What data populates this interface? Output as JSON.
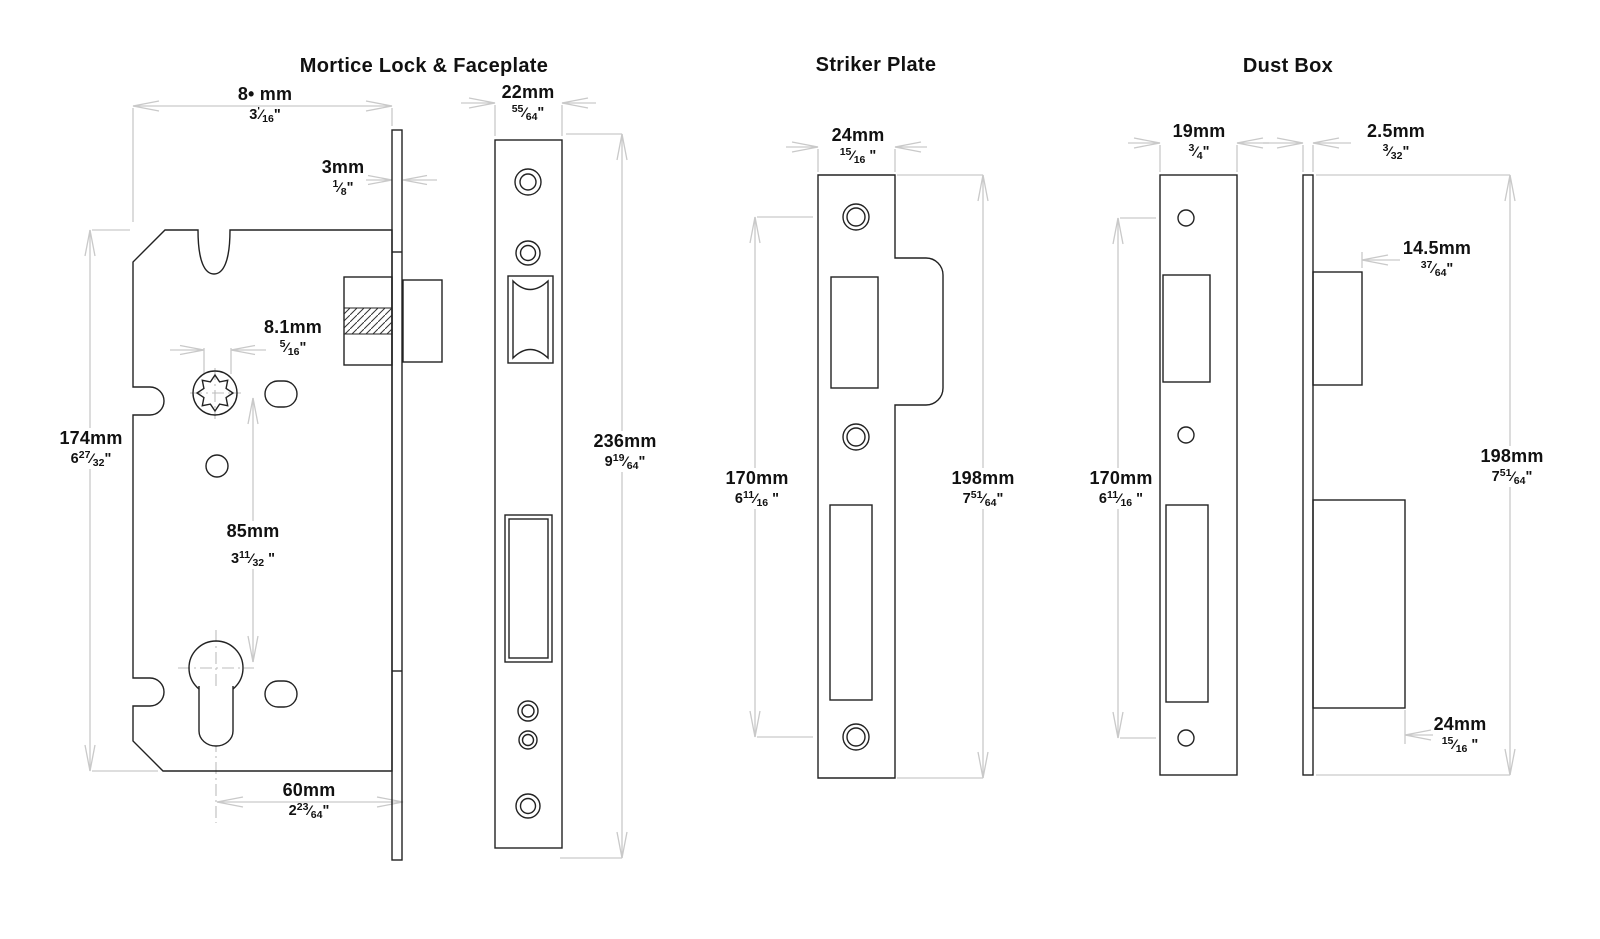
{
  "meta": {
    "background": "#ffffff",
    "outline_color": "#222222",
    "dim_color": "#c9c9c9",
    "text_color": "#111111"
  },
  "glyphs": {
    "fraction_slash": "⁄"
  },
  "sections": {
    "mortice": {
      "title": "Mortice Lock & Faceplate"
    },
    "striker": {
      "title": "Striker Plate"
    },
    "dustbox": {
      "title": "Dust Box"
    }
  },
  "labels": {
    "ml_case_width": {
      "mm": "8• mm",
      "whole": "3",
      "num": "'",
      "den": "16",
      "suffix": "\""
    },
    "ml_face_thickness": {
      "mm": "3mm",
      "whole": "",
      "num": "1",
      "den": "8",
      "suffix": "\""
    },
    "ml_faceplate_width": {
      "mm": "22mm",
      "whole": "",
      "num": "55",
      "den": "64",
      "suffix": "\""
    },
    "ml_follower": {
      "mm": "8.1mm",
      "whole": "",
      "num": "5",
      "den": "16",
      "suffix": "\""
    },
    "ml_case_height": {
      "mm": "174mm",
      "whole": "6",
      "num": "27",
      "den": "32",
      "suffix": "\""
    },
    "ml_centres": {
      "mm": "85mm",
      "whole": "3",
      "num": "11",
      "den": "32",
      "suffix": " \""
    },
    "ml_backset": {
      "mm": "60mm",
      "whole": "2",
      "num": "23",
      "den": "64",
      "suffix": "\""
    },
    "ml_faceplate_height": {
      "mm": "236mm",
      "whole": "9",
      "num": "19",
      "den": "64",
      "suffix": "\""
    },
    "sp_width": {
      "mm": "24mm",
      "whole": "",
      "num": "15",
      "den": "16",
      "suffix": " \""
    },
    "sp_centres": {
      "mm": "170mm",
      "whole": "6",
      "num": "11",
      "den": "16",
      "suffix": " \""
    },
    "sp_height": {
      "mm": "198mm",
      "whole": "7",
      "num": "51",
      "den": "64",
      "suffix": "\""
    },
    "db_width": {
      "mm": "19mm",
      "whole": "",
      "num": "3",
      "den": "4",
      "suffix": "\""
    },
    "db_thickness": {
      "mm": "2.5mm",
      "whole": "",
      "num": "3",
      "den": "32",
      "suffix": "\""
    },
    "db_upper_depth": {
      "mm": "14.5mm",
      "whole": "",
      "num": "37",
      "den": "64",
      "suffix": "\""
    },
    "db_centres": {
      "mm": "170mm",
      "whole": "6",
      "num": "11",
      "den": "16",
      "suffix": " \""
    },
    "db_height": {
      "mm": "198mm",
      "whole": "7",
      "num": "51",
      "den": "64",
      "suffix": "\""
    },
    "db_lower_depth": {
      "mm": "24mm",
      "whole": "",
      "num": "15",
      "den": "16",
      "suffix": " \""
    }
  }
}
